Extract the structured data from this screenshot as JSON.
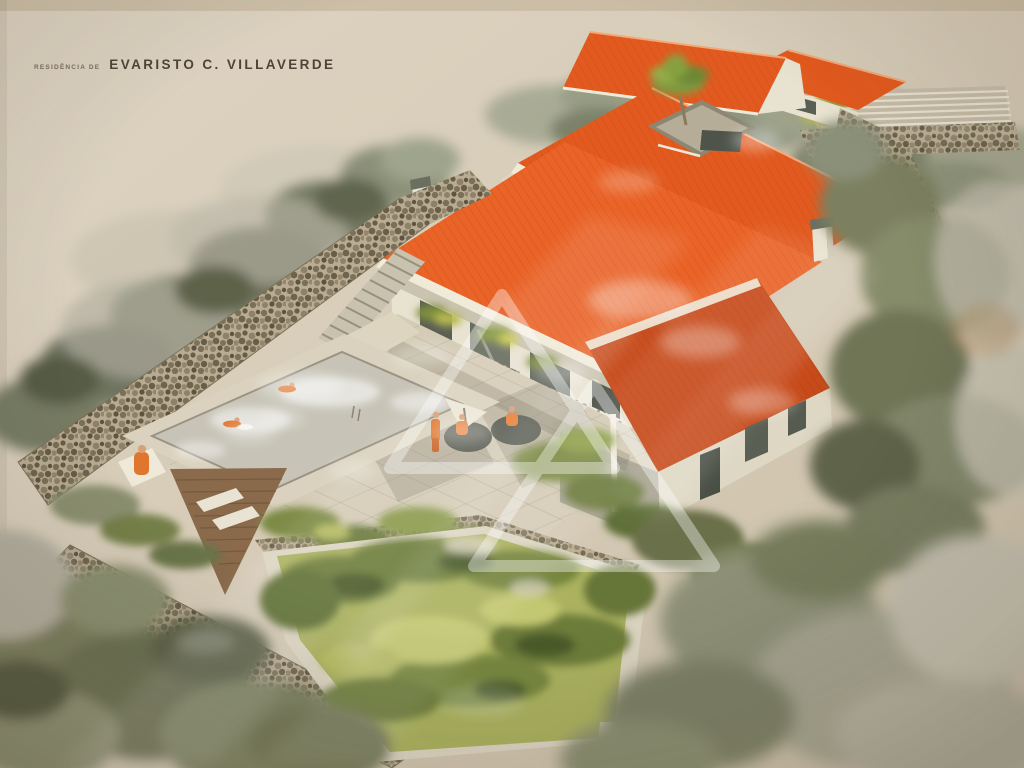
{
  "artwork": {
    "caption_prefix": "RESIDÊNCIA DE",
    "caption_name": "EVARISTO C. VILLAVERDE",
    "scene_elements": [
      "watercolor-paper",
      "background-trees",
      "upper-gable-roof",
      "garage-building",
      "pergola-carport",
      "upper-floor-roof",
      "courtyard-opening",
      "palm-tree",
      "main-roof",
      "chimneys",
      "lower-wing-roof",
      "house-facade",
      "facade-windows",
      "planter-boxes",
      "stone-walls",
      "staircases",
      "terrace-patio",
      "pierced-screen-wall",
      "patio-figures",
      "patio-tables",
      "parasol",
      "swimming-pool",
      "swimmers",
      "sunbather",
      "wooden-deck",
      "lounge-chairs",
      "lawn-garden",
      "garden-path",
      "shrubs",
      "watermark-triangles",
      "glass-glare"
    ]
  },
  "colors": {
    "paper": "#d7ccb8",
    "paper_light": "#e0d6c4",
    "paper_dark": "#c7bba3",
    "paper_edge": "#bfae94",
    "roof": "#e25a1f",
    "roof_bright": "#ea6327",
    "roof_dark": "#c74a1a",
    "roof_ridge": "#f2a878",
    "wall": "#e8e2d1",
    "wall_shadow": "#c2bba8",
    "fascia": "#f0ead9",
    "window": "#5a5f53",
    "stone": "#b9ac92",
    "stone_dark": "#6e644e",
    "screen": "#ece6d6",
    "terrace": "#d5ccb7",
    "pool_deck": "#dad2be",
    "water": "#c7c4b7",
    "lawn": "#abb25f",
    "lawn_dark": "#6d7d3a",
    "lawn_deep": "#4c5c2c",
    "lawn_light": "#c3c771",
    "foliage": "#7a7e5f",
    "foliage_dark": "#565b43",
    "foliage_gray": "#b2aea0",
    "wood": "#8a6a4b",
    "figure": "#e0762e",
    "skin": "#d9a077",
    "table": "#50544a",
    "glare": "#ffffff",
    "caption": "#4e4337"
  }
}
